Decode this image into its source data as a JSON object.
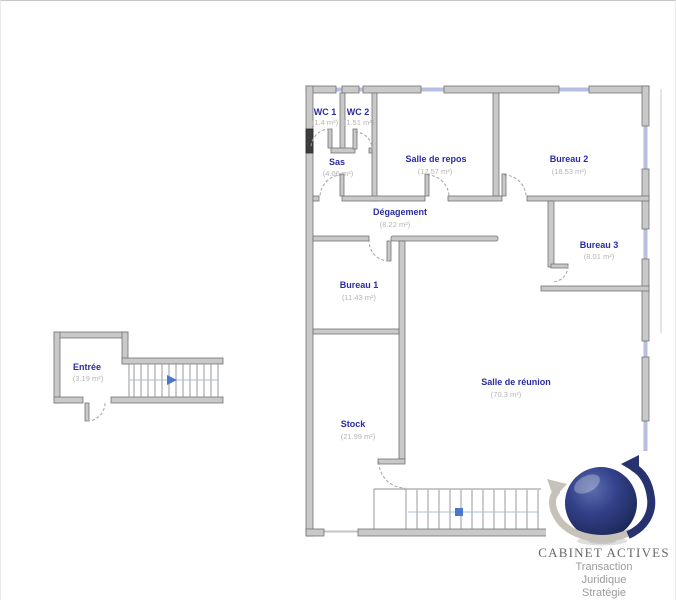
{
  "plan": {
    "type": "floor-plan",
    "rooms": [
      {
        "name": "WC 1",
        "area": "(1.4 m²)"
      },
      {
        "name": "WC 2",
        "area": "(1.51 m²)"
      },
      {
        "name": "Sas",
        "area": "(4.06 m²)"
      },
      {
        "name": "Salle de repos",
        "area": "(12.57 m²)"
      },
      {
        "name": "Bureau 2",
        "area": "(18.53 m²)"
      },
      {
        "name": "Dégagement",
        "area": "(8.22 m²)"
      },
      {
        "name": "Bureau 1",
        "area": "(11.43 m²)"
      },
      {
        "name": "Bureau 3",
        "area": "(8.01 m²)"
      },
      {
        "name": "Salle de réunion",
        "area": "(70.3 m²)"
      },
      {
        "name": "Stock",
        "area": "(21.99 m²)"
      },
      {
        "name": "Entrée",
        "area": "(3.19 m²)"
      }
    ],
    "colors": {
      "wall_fill": "#c9c9c9",
      "wall_stroke": "#737373",
      "window": "#b7bee2",
      "room_name": "#2b2ba3",
      "room_area": "#b4b4b4",
      "door_arc": "#a3a3a3",
      "stair_center_line": "#a9c0d8",
      "stair_marker_blue": "#4b77cc",
      "duct_dark": "#3d3d3d"
    }
  },
  "logo": {
    "brand": "CABINET ACTIVES",
    "taglines": [
      "Transaction",
      "Juridique",
      "Stratégie"
    ],
    "colors": {
      "sphere_navy": "#27336e",
      "swoosh_silver": "#c6c2ba",
      "brand_text": "#676767",
      "tagline_text": "#9b9b9b"
    }
  }
}
